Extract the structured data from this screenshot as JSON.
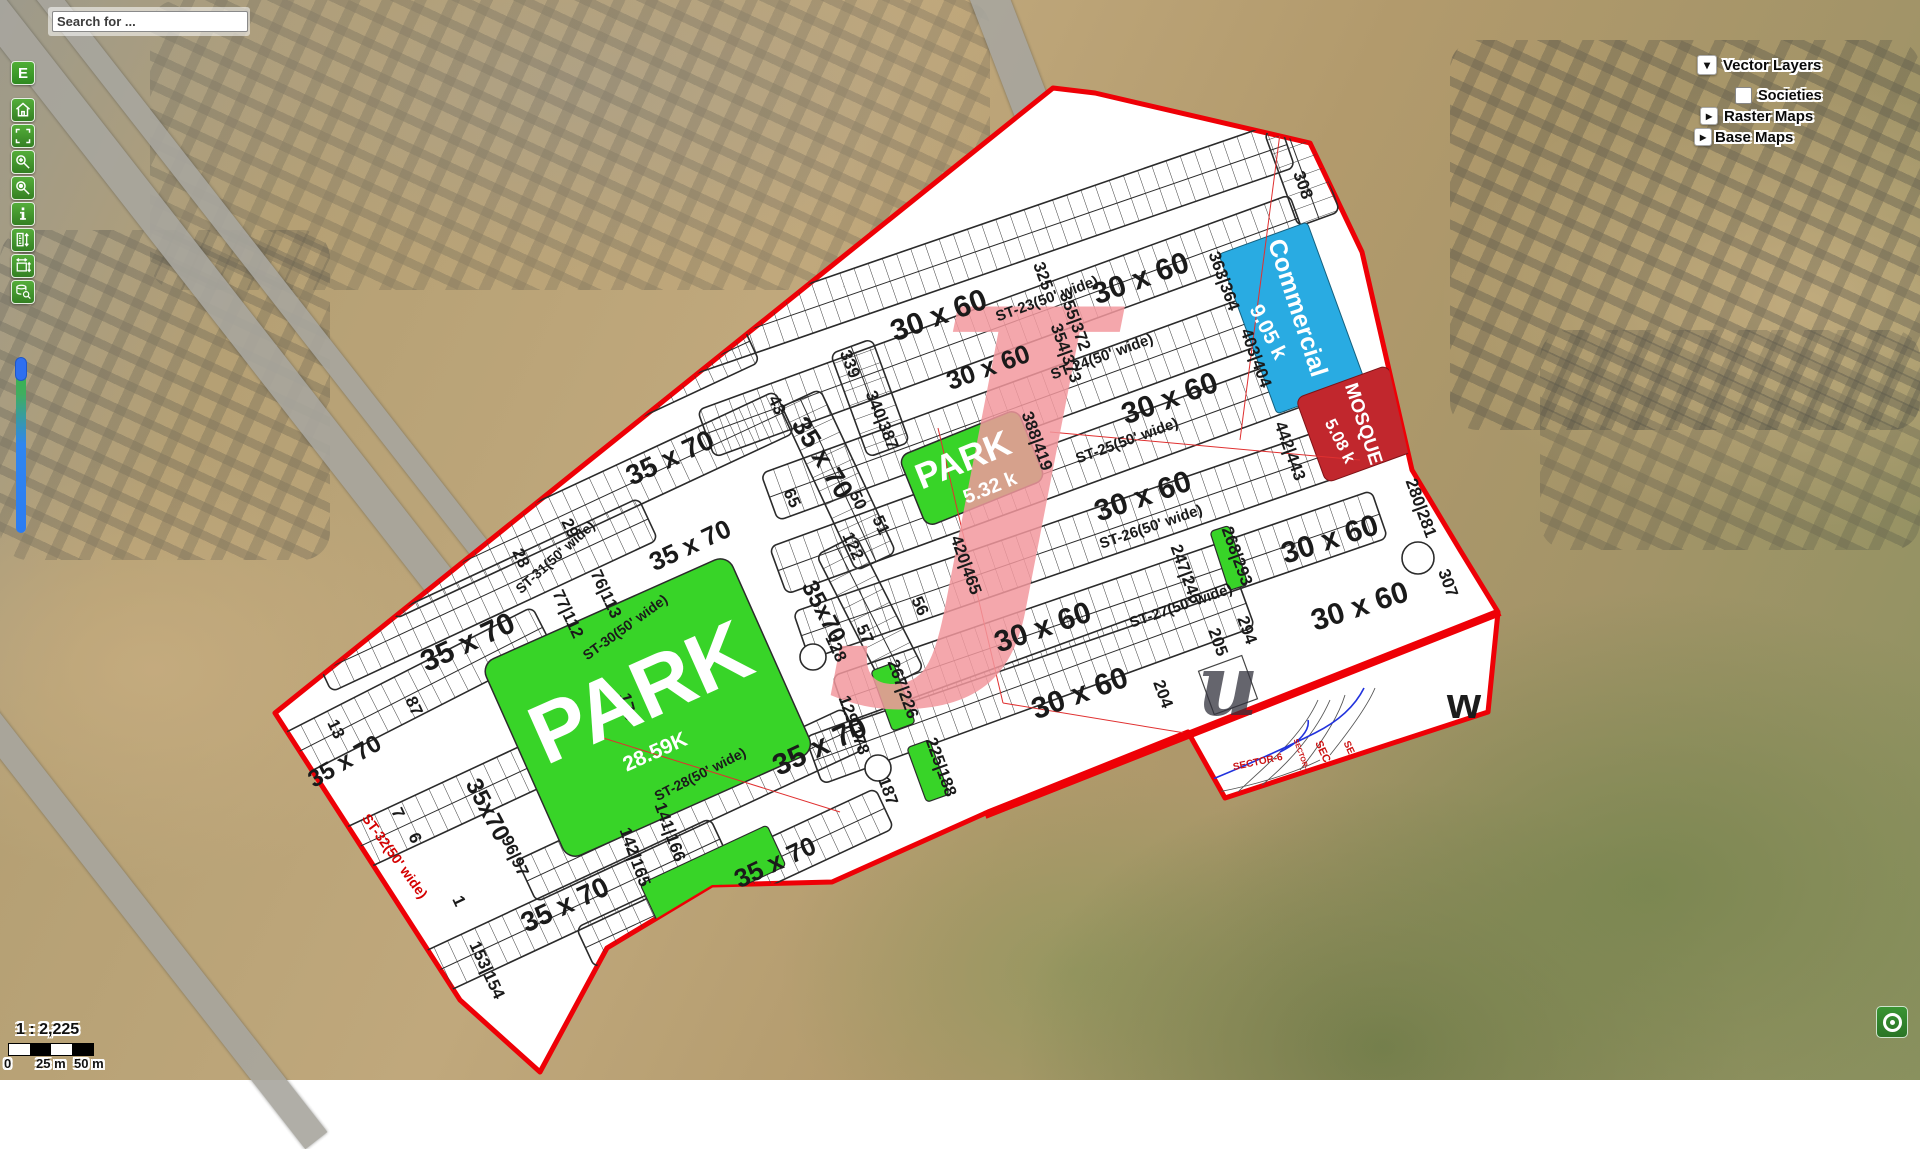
{
  "ui": {
    "search_placeholder": "Search for ...",
    "edit_button": "E",
    "toolbar_icons": [
      "home",
      "zoom-extent",
      "zoom-in",
      "zoom-previous",
      "identify-info",
      "measure-length",
      "measure-area",
      "query-attributes"
    ],
    "layers": {
      "vector_layers": "Vector Layers",
      "societies": "Societies",
      "raster_maps": "Raster Maps",
      "base_maps": "Base Maps",
      "collapse_icon": "▾",
      "expand_icon": "▸"
    },
    "scale_ratio": "1 : 2,225",
    "scale_ticks": [
      "0",
      "25 m",
      "50 m"
    ],
    "attribution_icon": "attribution-ring"
  },
  "colors": {
    "boundary_red": "#ee0006",
    "park_green": "#38d428",
    "commercial_blue": "#29abe2",
    "mosque_red": "#c1272d",
    "toolbar_green": "#3f9a2f",
    "watermark_pink": "rgba(242,152,158,0.85)"
  },
  "plan": {
    "size_labels": [
      {
        "t": "30 x 60",
        "x": 939,
        "y": 316,
        "r": -20,
        "s": 30
      },
      {
        "t": "30 x 60",
        "x": 1141,
        "y": 279,
        "r": -20,
        "s": 30
      },
      {
        "t": "30 x 60",
        "x": 988,
        "y": 367,
        "r": -20,
        "s": 26
      },
      {
        "t": "30 x 60",
        "x": 1170,
        "y": 399,
        "r": -20,
        "s": 30
      },
      {
        "t": "30 x 60",
        "x": 1143,
        "y": 497,
        "r": -19,
        "s": 30
      },
      {
        "t": "30 x 60",
        "x": 1330,
        "y": 540,
        "r": -18,
        "s": 30
      },
      {
        "t": "30 x 60",
        "x": 1043,
        "y": 628,
        "r": -19,
        "s": 30
      },
      {
        "t": "30 x 60",
        "x": 1360,
        "y": 607,
        "r": -18,
        "s": 30
      },
      {
        "t": "30 x 60",
        "x": 1080,
        "y": 694,
        "r": -20,
        "s": 30
      },
      {
        "t": "35 x 70",
        "x": 670,
        "y": 458,
        "r": -25,
        "s": 28
      },
      {
        "t": "35 x 70",
        "x": 690,
        "y": 545,
        "r": -25,
        "s": 26
      },
      {
        "t": "35 x 70",
        "x": 468,
        "y": 643,
        "r": -25,
        "s": 30
      },
      {
        "t": "35 x 70",
        "x": 345,
        "y": 762,
        "r": -30,
        "s": 24
      },
      {
        "t": "35 x 70",
        "x": 565,
        "y": 905,
        "r": -25,
        "s": 28
      },
      {
        "t": "35 x 70",
        "x": 820,
        "y": 747,
        "r": -25,
        "s": 30
      },
      {
        "t": "35 x 70",
        "x": 775,
        "y": 862,
        "r": -25,
        "s": 26
      },
      {
        "t": "35 x 70",
        "x": 822,
        "y": 458,
        "r": 58,
        "s": 27
      },
      {
        "t": "35x70",
        "x": 823,
        "y": 612,
        "r": 62,
        "s": 24
      },
      {
        "t": "35x70",
        "x": 487,
        "y": 810,
        "r": 62,
        "s": 24
      }
    ],
    "street_labels": [
      {
        "t": "ST-23(50' wide)",
        "x": 1047,
        "y": 299,
        "r": -20,
        "s": 15
      },
      {
        "t": "ST-24(50' wide)",
        "x": 1102,
        "y": 357,
        "r": -20,
        "s": 15
      },
      {
        "t": "ST-25(50' wide)",
        "x": 1127,
        "y": 441,
        "r": -20,
        "s": 15
      },
      {
        "t": "ST-26(50' wide)",
        "x": 1151,
        "y": 527,
        "r": -19,
        "s": 15
      },
      {
        "t": "ST-27(50' wide)",
        "x": 1181,
        "y": 606,
        "r": -19,
        "s": 15
      },
      {
        "t": "ST-28(50' wide)",
        "x": 700,
        "y": 774,
        "r": -27,
        "s": 14
      },
      {
        "t": "ST-30(50' wide)",
        "x": 625,
        "y": 627,
        "r": -36,
        "s": 14
      },
      {
        "t": "ST-31(50' wide)",
        "x": 555,
        "y": 557,
        "r": -42,
        "s": 14
      },
      {
        "t": "ST-32(50' wide)",
        "x": 395,
        "y": 856,
        "r": 54,
        "s": 14,
        "c": "#d40000"
      }
    ],
    "plot_numbers": [
      {
        "t": "308",
        "x": 1303,
        "y": 185,
        "r": 70
      },
      {
        "t": "325",
        "x": 1043,
        "y": 276,
        "r": 70
      },
      {
        "t": "339",
        "x": 850,
        "y": 364,
        "r": 68
      },
      {
        "t": "363|364",
        "x": 1224,
        "y": 281,
        "r": 70
      },
      {
        "t": "355|372",
        "x": 1075,
        "y": 321,
        "r": 70
      },
      {
        "t": "354|373",
        "x": 1066,
        "y": 353,
        "r": 70
      },
      {
        "t": "403|404",
        "x": 1256,
        "y": 358,
        "r": 70
      },
      {
        "t": "340|387",
        "x": 882,
        "y": 420,
        "r": 68
      },
      {
        "t": "388|419",
        "x": 1037,
        "y": 441,
        "r": 70
      },
      {
        "t": "420|465",
        "x": 966,
        "y": 565,
        "r": 70
      },
      {
        "t": "442|443",
        "x": 1290,
        "y": 451,
        "r": 70
      },
      {
        "t": "268|293",
        "x": 1237,
        "y": 556,
        "r": 70
      },
      {
        "t": "247|246",
        "x": 1186,
        "y": 574,
        "r": 70
      },
      {
        "t": "280|281",
        "x": 1421,
        "y": 508,
        "r": 70
      },
      {
        "t": "307",
        "x": 1448,
        "y": 583,
        "r": 70
      },
      {
        "t": "294",
        "x": 1247,
        "y": 630,
        "r": 70
      },
      {
        "t": "205",
        "x": 1218,
        "y": 642,
        "r": 70
      },
      {
        "t": "204",
        "x": 1163,
        "y": 694,
        "r": 70
      },
      {
        "t": "267|226",
        "x": 903,
        "y": 689,
        "r": 70
      },
      {
        "t": "225|188",
        "x": 941,
        "y": 767,
        "r": 70
      },
      {
        "t": "129|178",
        "x": 854,
        "y": 725,
        "r": 70
      },
      {
        "t": "187",
        "x": 888,
        "y": 791,
        "r": 70
      },
      {
        "t": "141|166",
        "x": 670,
        "y": 832,
        "r": 70
      },
      {
        "t": "142|165",
        "x": 635,
        "y": 857,
        "r": 70
      },
      {
        "t": "96|97",
        "x": 515,
        "y": 856,
        "r": 65
      },
      {
        "t": "153|154",
        "x": 487,
        "y": 970,
        "r": 65
      },
      {
        "t": "179",
        "x": 628,
        "y": 707,
        "r": 75
      },
      {
        "t": "128",
        "x": 836,
        "y": 648,
        "r": 65
      },
      {
        "t": "57",
        "x": 865,
        "y": 634,
        "r": 65
      },
      {
        "t": "56",
        "x": 920,
        "y": 606,
        "r": 65
      },
      {
        "t": "51",
        "x": 881,
        "y": 525,
        "r": 65
      },
      {
        "t": "122",
        "x": 853,
        "y": 546,
        "r": 65
      },
      {
        "t": "50",
        "x": 858,
        "y": 500,
        "r": 65
      },
      {
        "t": "65",
        "x": 792,
        "y": 498,
        "r": 65
      },
      {
        "t": "43",
        "x": 777,
        "y": 405,
        "r": 65
      },
      {
        "t": "29",
        "x": 570,
        "y": 528,
        "r": 65
      },
      {
        "t": "28",
        "x": 521,
        "y": 558,
        "r": 65
      },
      {
        "t": "87",
        "x": 414,
        "y": 706,
        "r": 65
      },
      {
        "t": "76|113",
        "x": 606,
        "y": 594,
        "r": 65
      },
      {
        "t": "77|112",
        "x": 568,
        "y": 614,
        "r": 65
      },
      {
        "t": "13",
        "x": 336,
        "y": 729,
        "r": 65
      },
      {
        "t": "7",
        "x": 398,
        "y": 813,
        "r": 65
      },
      {
        "t": "6",
        "x": 415,
        "y": 838,
        "r": 65
      },
      {
        "t": "1",
        "x": 459,
        "y": 901,
        "r": 65
      }
    ],
    "facility_labels": [
      {
        "t": "Commercial",
        "x": 1297,
        "y": 308,
        "r": 72,
        "s": 25,
        "c": "#fff"
      },
      {
        "t": "9.05 k",
        "x": 1268,
        "y": 332,
        "r": 63,
        "s": 21,
        "c": "#fff"
      },
      {
        "t": "MOSQUE",
        "x": 1363,
        "y": 424,
        "r": 72,
        "s": 19,
        "c": "#fff"
      },
      {
        "t": "5.08 k",
        "x": 1340,
        "y": 441,
        "r": 63,
        "s": 17,
        "c": "#fff"
      },
      {
        "t": "PARK",
        "x": 963,
        "y": 460,
        "r": -22,
        "s": 36,
        "c": "#fff"
      },
      {
        "t": "5.32 k",
        "x": 990,
        "y": 488,
        "r": -22,
        "s": 20,
        "c": "#fff"
      },
      {
        "t": "PARK",
        "x": 640,
        "y": 692,
        "r": -24,
        "s": 84,
        "c": "#fff"
      },
      {
        "t": "28.59K",
        "x": 655,
        "y": 752,
        "r": -24,
        "s": 21,
        "c": "#fff"
      }
    ],
    "watermarks": [
      {
        "t": "J",
        "x": 1000,
        "y": 470,
        "r": 0,
        "s": 430,
        "c": "rgba(242,152,158,0.85)",
        "f": "serif"
      },
      {
        "t": "u",
        "x": 1228,
        "y": 686,
        "r": 0,
        "s": 84,
        "c": "rgba(50,50,60,0.75)",
        "f": "serif"
      },
      {
        "t": "w",
        "x": 1464,
        "y": 704,
        "r": 0,
        "s": 44,
        "c": "#1c1c1c"
      }
    ],
    "sector_labels": [
      {
        "t": "SECTOR-6",
        "x": 1258,
        "y": 763,
        "r": -12,
        "s": 10,
        "c": "#cc1111"
      },
      {
        "t": "SECTOR-4",
        "x": 1301,
        "y": 756,
        "r": 70,
        "s": 7,
        "c": "#cc1111"
      },
      {
        "t": "SEC",
        "x": 1322,
        "y": 752,
        "r": 65,
        "s": 11,
        "c": "#cc1111"
      },
      {
        "t": "SE",
        "x": 1348,
        "y": 748,
        "r": 65,
        "s": 10,
        "c": "#cc1111"
      }
    ]
  }
}
